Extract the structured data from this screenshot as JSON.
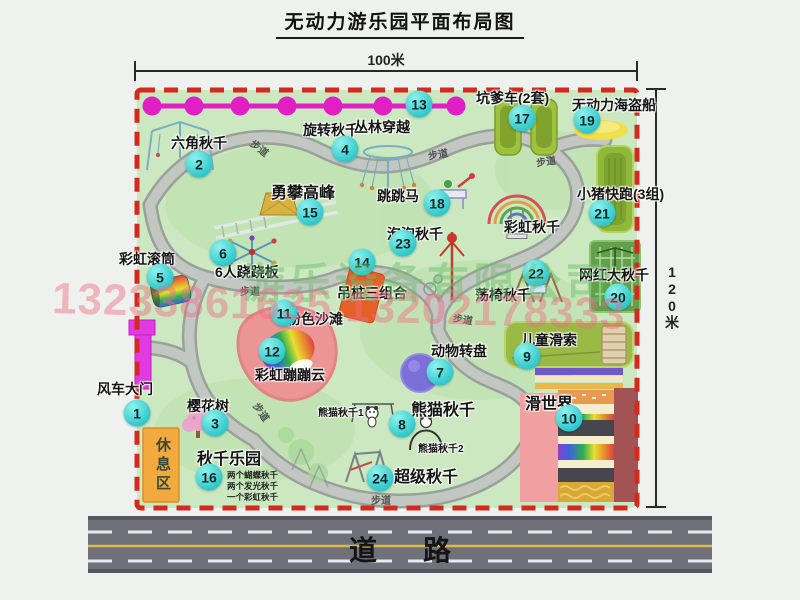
{
  "title": "无动力游乐园平面布局图",
  "dimensions": {
    "width": "100米",
    "height": "120米"
  },
  "road_label": "道路",
  "path_label": "步道",
  "rest_area_label": "休息区",
  "rainbow_swing_label": "彩虹秋千",
  "panda_swing_1": "熊猫秋千1",
  "panda_swing_2": "熊猫秋千2",
  "swing_park_notes": [
    "两个蝴蝶秋千",
    "两个发光秋千",
    "一个彩虹秋千"
  ],
  "watermark": {
    "company": "游乐设备有限公司",
    "phones": "13233861635 13202178333"
  },
  "attractions": [
    {
      "num": "1",
      "label": "风车大门"
    },
    {
      "num": "2",
      "label": "六角秋千"
    },
    {
      "num": "3",
      "label": "樱花树"
    },
    {
      "num": "4",
      "label": "旋转秋千"
    },
    {
      "num": "5",
      "label": "彩虹滚筒"
    },
    {
      "num": "6",
      "label": "6人跷跷板"
    },
    {
      "num": "7",
      "label": "动物转盘"
    },
    {
      "num": "8",
      "label": "熊猫秋千"
    },
    {
      "num": "9",
      "label": "儿童滑索"
    },
    {
      "num": "10",
      "label": "滑世界"
    },
    {
      "num": "11",
      "label": "粉色沙滩"
    },
    {
      "num": "12",
      "label": "彩虹蹦蹦云"
    },
    {
      "num": "13",
      "label": "丛林穿越"
    },
    {
      "num": "14",
      "label": "吊桩三组合"
    },
    {
      "num": "15",
      "label": "勇攀高峰"
    },
    {
      "num": "16",
      "label": "秋千乐园"
    },
    {
      "num": "17",
      "label": "坑爹车(2套)"
    },
    {
      "num": "18",
      "label": "跳跳马"
    },
    {
      "num": "19",
      "label": "无动力海盗船"
    },
    {
      "num": "20",
      "label": "网红大秋千"
    },
    {
      "num": "21",
      "label": "小猪快跑(3组)"
    },
    {
      "num": "22",
      "label": "荡椅秋千"
    },
    {
      "num": "23",
      "label": "泡泡秋千"
    },
    {
      "num": "24",
      "label": "超级秋千"
    }
  ],
  "colors": {
    "park_green": "#cbe8c0",
    "border_red": "#d42a1e",
    "badge_cyan": "#2fc7cb",
    "magenta": "#e11fc4",
    "road_gray": "#70707a",
    "rest_orange": "#f2a93e"
  }
}
